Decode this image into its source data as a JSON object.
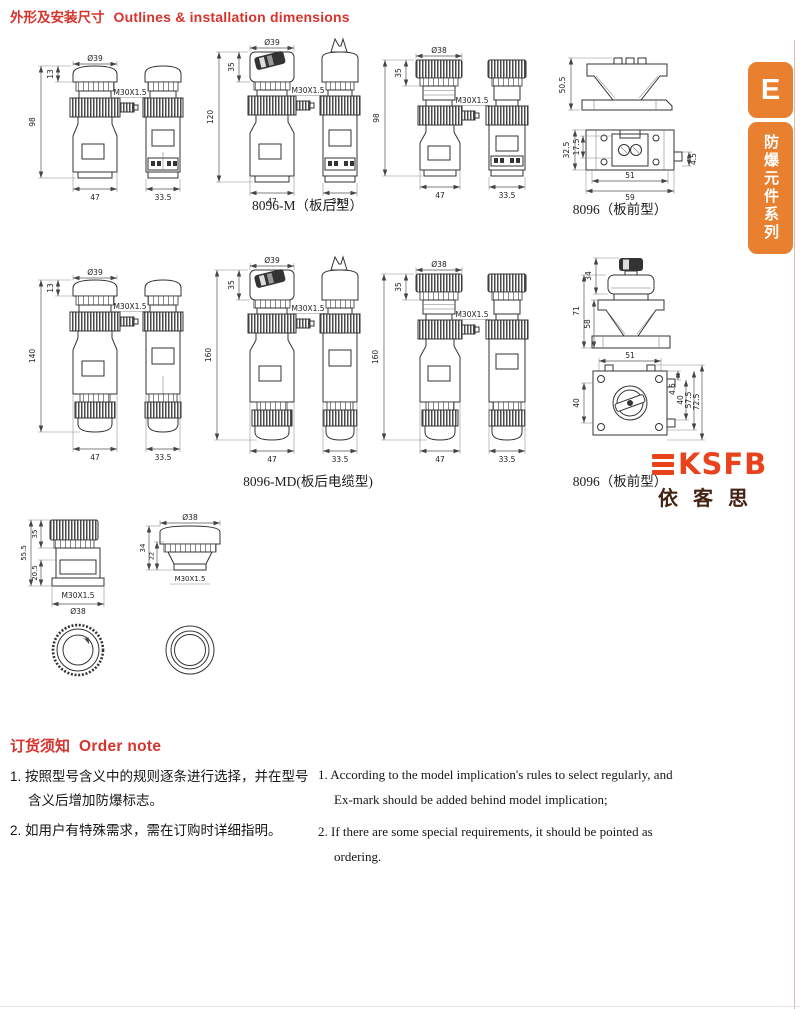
{
  "header": {
    "title_zh": "外形及安装尺寸",
    "title_en": "Outlines & installation dimensions"
  },
  "side_tab": {
    "letter": "E",
    "series": "防爆元件系列"
  },
  "logo": {
    "latin": "KSFB",
    "zh": "依客思"
  },
  "figures": {
    "row1": {
      "a": {
        "dia": "Ø39",
        "lip": "13",
        "h": "98",
        "thread": "M30X1.5",
        "w": "47",
        "sw": "33.5"
      },
      "b": {
        "dia": "Ø39",
        "head": "35",
        "h": "120",
        "thread": "M30X1.5",
        "w": "47",
        "sw": "33.5"
      },
      "c": {
        "dia": "Ø38",
        "head": "35",
        "h": "98",
        "thread": "M30X1.5",
        "w": "47",
        "sw": "33.5"
      },
      "d": {
        "bracket_h": "50.5",
        "outer_h": "32.5",
        "inner_h": "17.5",
        "inner_w": "51",
        "outer_w": "59",
        "offset": "4.5"
      },
      "caption_left": "8096-M（板后型）",
      "caption_right": "8096（板前型）"
    },
    "row2": {
      "e": {
        "dia": "Ø39",
        "lip": "13",
        "h": "140",
        "thread": "M30X1.5",
        "w": "47",
        "sw": "33.5"
      },
      "f": {
        "dia": "Ø39",
        "head": "35",
        "h": "160",
        "thread": "M30X1.5",
        "w": "47",
        "sw": "33.5"
      },
      "g": {
        "dia": "Ø38",
        "head": "35",
        "h": "160",
        "thread": "M30X1.5",
        "w": "47",
        "sw": "33.5"
      },
      "h": {
        "knob": "34",
        "total": "71",
        "lower": "58",
        "top_w": "51",
        "left_h": "40",
        "r1": "4.5",
        "r2": "40",
        "r3": "57.5",
        "r4": "72.5"
      },
      "caption_left": "8096-MD(板后电缆型)",
      "caption_right": "8096（板前型）"
    },
    "row3": {
      "i": {
        "h": "55.5",
        "head": "35",
        "lower": "20.5",
        "thread": "M30X1.5",
        "dia": "Ø38"
      },
      "j": {
        "dia": "Ø38",
        "h1": "34",
        "h2": "22",
        "thread": "M30X1.5"
      }
    }
  },
  "order_note": {
    "heading_zh": "订货须知",
    "heading_en": "Order note",
    "zh_items": [
      "1. 按照型号含义中的规则逐条进行选择，并在型号含义后增加防爆标志。",
      "2. 如用户有特殊需求，需在订购时详细指明。"
    ],
    "en_items": [
      "1. According to the model implication's rules to select regularly, and Ex-mark should be added behind model implication;",
      "2. If there are some special requirements, it should be pointed as ordering."
    ]
  },
  "colors": {
    "accent_red": "#d6332c",
    "tab_orange": "#e8802f",
    "logo_red": "#e8431c"
  }
}
